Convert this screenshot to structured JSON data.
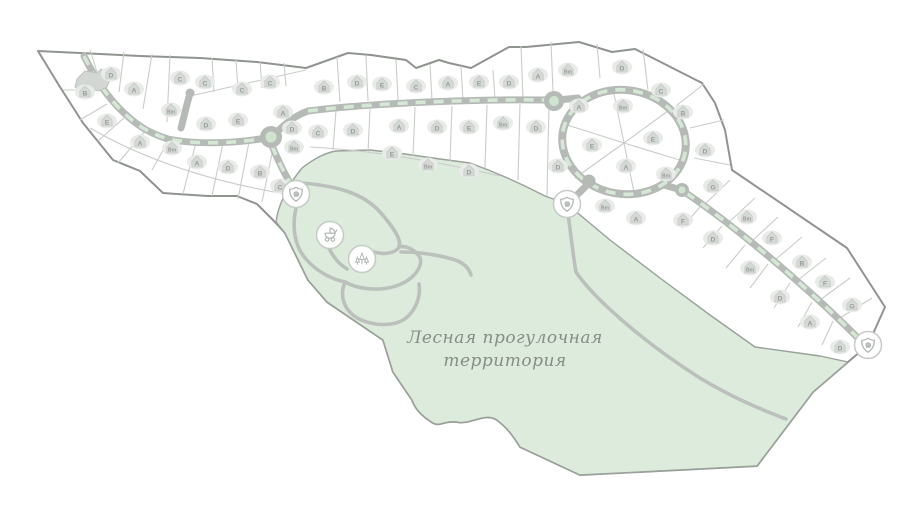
{
  "map": {
    "forest_label": {
      "line1": "Лесная прогулочная",
      "line2": "территория"
    },
    "colors": {
      "background": "#ffffff",
      "forest_fill": "#dcebdc",
      "boundary": "#8f948f",
      "plot_divider": "#c9ccc9",
      "road": "#b6bab6",
      "road_median": "#d5e8d5",
      "forest_path": "#bcc0bc",
      "house": "#d5d9d5",
      "house_halo": "#e8ebe8",
      "house_letter": "#989d98",
      "marker_ring": "#c6cac6",
      "marker_icon": "#b2b6b2",
      "label_text": "#878c87"
    },
    "plots": [
      {
        "label": "B",
        "x": 85,
        "y": 92
      },
      {
        "label": "D",
        "x": 111,
        "y": 74
      },
      {
        "label": "A",
        "x": 134,
        "y": 89
      },
      {
        "label": "C",
        "x": 180,
        "y": 78
      },
      {
        "label": "C",
        "x": 205,
        "y": 82
      },
      {
        "label": "C",
        "x": 242,
        "y": 89
      },
      {
        "label": "C",
        "x": 270,
        "y": 82
      },
      {
        "label": "E",
        "x": 107,
        "y": 121
      },
      {
        "label": "Bm",
        "x": 171,
        "y": 110
      },
      {
        "label": "D",
        "x": 206,
        "y": 124
      },
      {
        "label": "E",
        "x": 238,
        "y": 120
      },
      {
        "label": "A",
        "x": 283,
        "y": 112
      },
      {
        "label": "D",
        "x": 292,
        "y": 128
      },
      {
        "label": "A",
        "x": 140,
        "y": 142
      },
      {
        "label": "Bm",
        "x": 172,
        "y": 148
      },
      {
        "label": "A",
        "x": 197,
        "y": 162
      },
      {
        "label": "D",
        "x": 228,
        "y": 167
      },
      {
        "label": "B",
        "x": 260,
        "y": 172
      },
      {
        "label": "Bm",
        "x": 294,
        "y": 147
      },
      {
        "label": "C",
        "x": 280,
        "y": 186
      },
      {
        "label": "B",
        "x": 324,
        "y": 87
      },
      {
        "label": "D",
        "x": 357,
        "y": 82
      },
      {
        "label": "E",
        "x": 382,
        "y": 84
      },
      {
        "label": "C",
        "x": 416,
        "y": 86
      },
      {
        "label": "A",
        "x": 448,
        "y": 83
      },
      {
        "label": "E",
        "x": 479,
        "y": 82
      },
      {
        "label": "D",
        "x": 509,
        "y": 82
      },
      {
        "label": "A",
        "x": 538,
        "y": 75
      },
      {
        "label": "Bm",
        "x": 568,
        "y": 70
      },
      {
        "label": "D",
        "x": 622,
        "y": 67
      },
      {
        "label": "C",
        "x": 661,
        "y": 90
      },
      {
        "label": "B",
        "x": 683,
        "y": 112
      },
      {
        "label": "C",
        "x": 318,
        "y": 132
      },
      {
        "label": "D",
        "x": 353,
        "y": 130
      },
      {
        "label": "A",
        "x": 399,
        "y": 126
      },
      {
        "label": "D",
        "x": 437,
        "y": 127
      },
      {
        "label": "E",
        "x": 469,
        "y": 127
      },
      {
        "label": "Bm",
        "x": 503,
        "y": 123
      },
      {
        "label": "D",
        "x": 536,
        "y": 127
      },
      {
        "label": "E",
        "x": 392,
        "y": 153
      },
      {
        "label": "Bm",
        "x": 428,
        "y": 165
      },
      {
        "label": "D",
        "x": 469,
        "y": 171
      },
      {
        "label": "D",
        "x": 558,
        "y": 166
      },
      {
        "label": "A",
        "x": 579,
        "y": 106
      },
      {
        "label": "Bm",
        "x": 623,
        "y": 106
      },
      {
        "label": "E",
        "x": 592,
        "y": 145
      },
      {
        "label": "E",
        "x": 653,
        "y": 138
      },
      {
        "label": "A",
        "x": 626,
        "y": 166
      },
      {
        "label": "Bm",
        "x": 666,
        "y": 174
      },
      {
        "label": "D",
        "x": 705,
        "y": 150
      },
      {
        "label": "G",
        "x": 713,
        "y": 186
      },
      {
        "label": "Bm",
        "x": 747,
        "y": 217
      },
      {
        "label": "F",
        "x": 772,
        "y": 238
      },
      {
        "label": "B",
        "x": 802,
        "y": 262
      },
      {
        "label": "F",
        "x": 825,
        "y": 282
      },
      {
        "label": "G",
        "x": 852,
        "y": 305
      },
      {
        "label": "Bm",
        "x": 605,
        "y": 206
      },
      {
        "label": "A",
        "x": 636,
        "y": 218
      },
      {
        "label": "F",
        "x": 683,
        "y": 220
      },
      {
        "label": "D",
        "x": 713,
        "y": 238
      },
      {
        "label": "Bm",
        "x": 750,
        "y": 268
      },
      {
        "label": "D",
        "x": 780,
        "y": 297
      },
      {
        "label": "A",
        "x": 810,
        "y": 322
      },
      {
        "label": "D",
        "x": 840,
        "y": 347
      }
    ],
    "clubhouse": {
      "x": 95,
      "y": 85
    },
    "markers": [
      {
        "id": "marker-1",
        "icon": "shield-leaf-icon",
        "x": 296,
        "y": 194
      },
      {
        "id": "marker-2",
        "icon": "stroller-icon",
        "x": 330,
        "y": 235
      },
      {
        "id": "marker-3",
        "icon": "trees-icon",
        "x": 362,
        "y": 259
      },
      {
        "id": "marker-4",
        "icon": "shield-leaf-icon",
        "x": 567,
        "y": 204
      },
      {
        "id": "marker-5",
        "icon": "shield-leaf-icon",
        "x": 868,
        "y": 345
      }
    ]
  }
}
